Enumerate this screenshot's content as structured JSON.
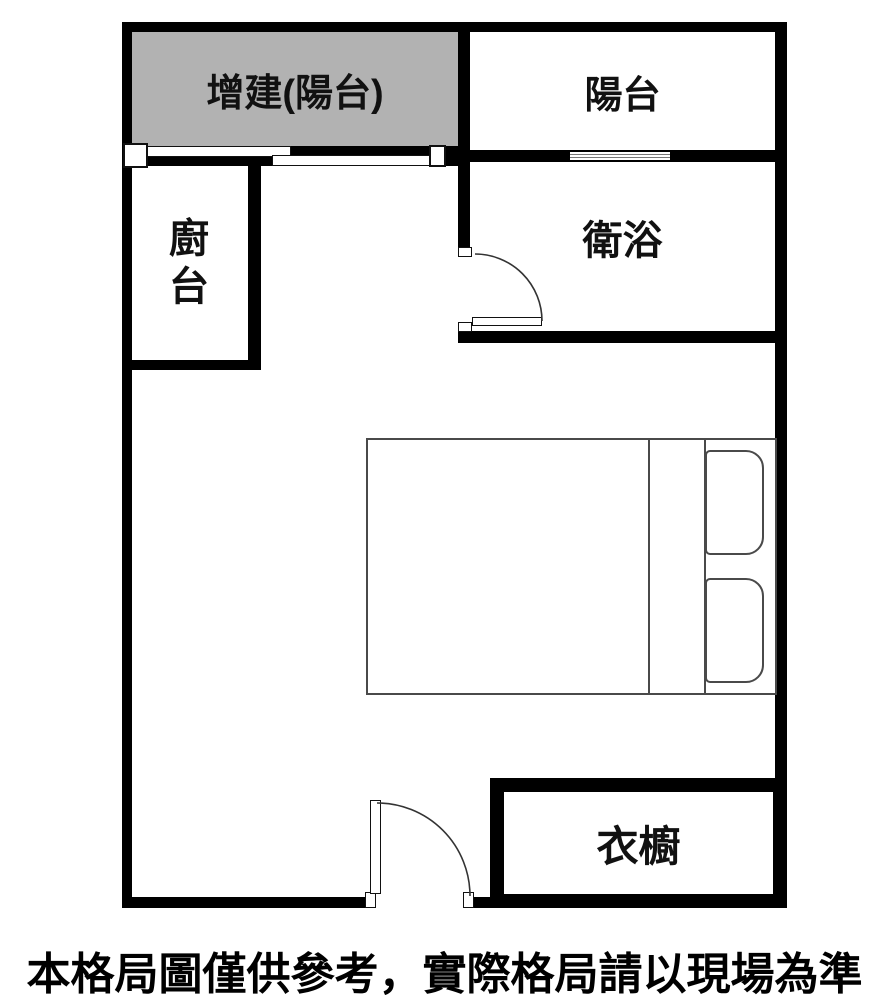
{
  "rooms": {
    "addition_balcony": "增建(陽台)",
    "balcony": "陽台",
    "kitchen": "廚台",
    "bathroom": "衛浴",
    "wardrobe": "衣櫥"
  },
  "caption": "本格局圖僅供參考，實際格局請以現場為準",
  "fixtures": {
    "bed": "double-bed-with-two-pillows",
    "bathroom_door": "swing-door-opening-into-bathroom",
    "entrance_door": "swing-door-at-bottom-wall",
    "balcony_window": "window-in-wall-between-balcony-and-bathroom",
    "addition_sliding_door": "offset-sliding-panels-below-addition-balcony"
  },
  "colors": {
    "wall": "#000000",
    "addition_fill": "#b2b2b2",
    "furniture_line": "#4a4a4a",
    "background": "#ffffff",
    "text": "#000000"
  }
}
